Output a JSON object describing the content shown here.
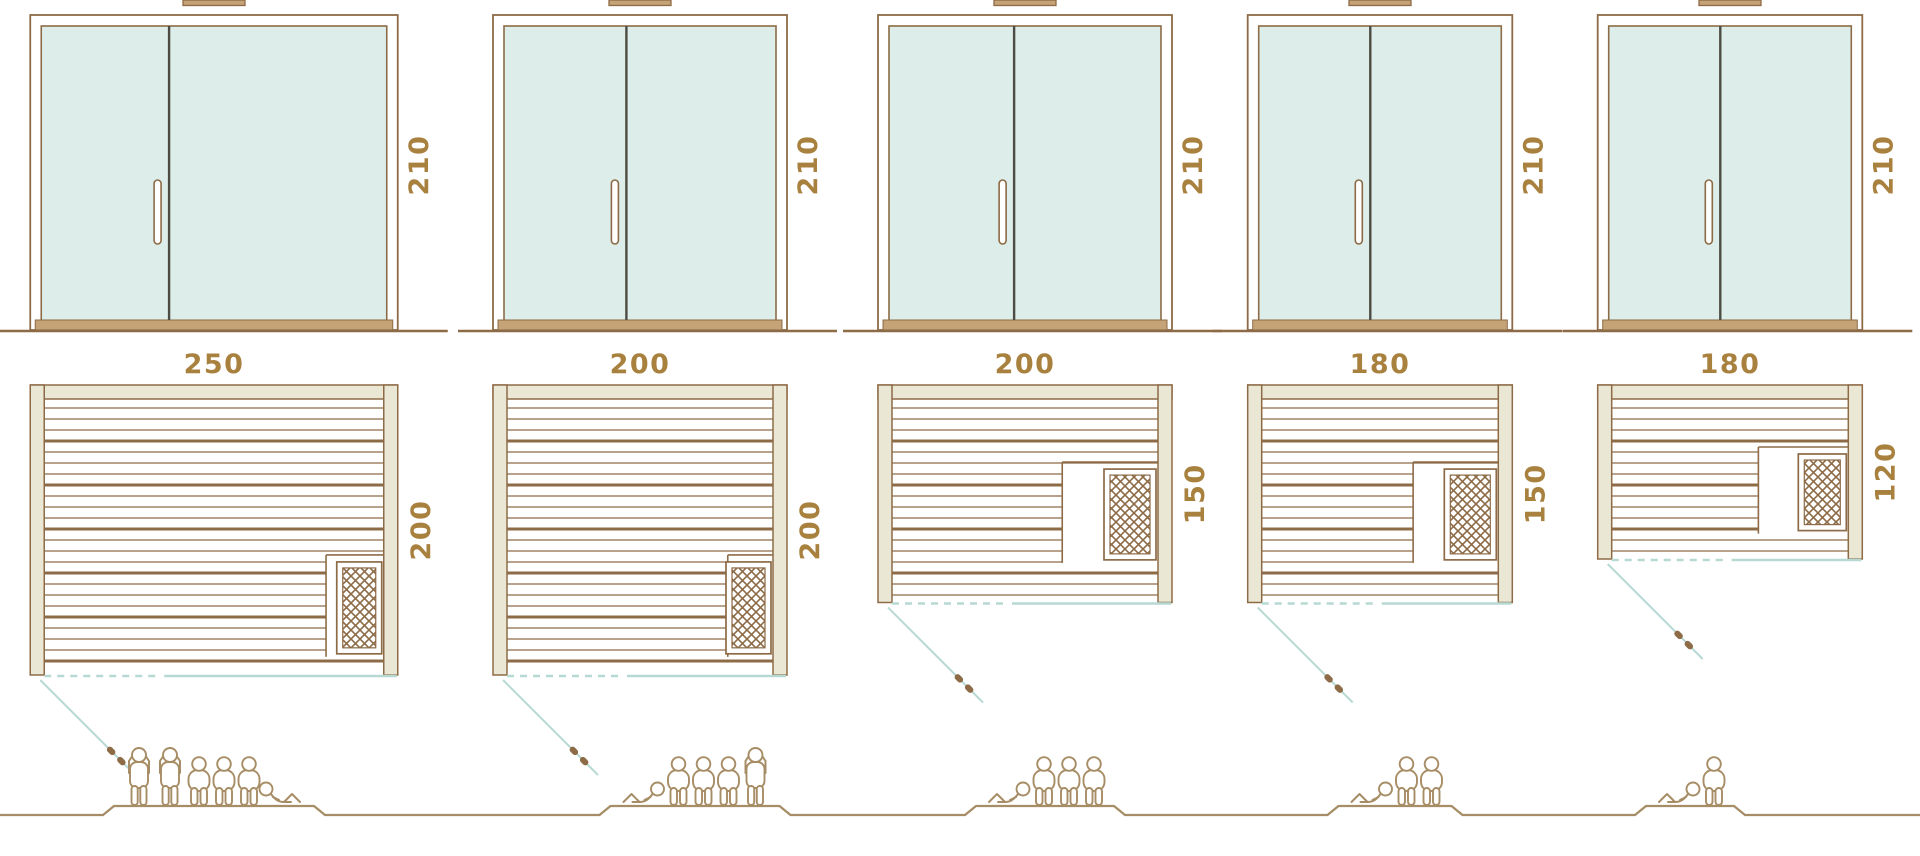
{
  "title": "Sauna size comparison diagram",
  "colors": {
    "line_brown": "#8d6b46",
    "label_gold": "#a9813f",
    "wall_fill": "#eae7d4",
    "glass_fill": "#ddede9",
    "divider_dark": "#4d4c44",
    "swing_teal": "#b7d9d3",
    "people_brown": "#a78d65",
    "threshold_tan": "#c5a377",
    "white": "#ffffff"
  },
  "units": [
    {
      "name": "sauna-250x200",
      "door_height_label": "210",
      "width_label": "250",
      "depth_label": "200",
      "door_height_cm": 210,
      "width_cm": 250,
      "depth_cm": 200,
      "capacity": {
        "standing": 2,
        "seated": 3,
        "lying": 1
      }
    },
    {
      "name": "sauna-200x200",
      "door_height_label": "210",
      "width_label": "200",
      "depth_label": "200",
      "door_height_cm": 210,
      "width_cm": 200,
      "depth_cm": 200,
      "capacity": {
        "standing": 1,
        "seated": 3,
        "lying": 1
      }
    },
    {
      "name": "sauna-200x150",
      "door_height_label": "210",
      "width_label": "200",
      "depth_label": "150",
      "door_height_cm": 210,
      "width_cm": 200,
      "depth_cm": 150,
      "capacity": {
        "standing": 0,
        "seated": 3,
        "lying": 1
      }
    },
    {
      "name": "sauna-180x150",
      "door_height_label": "210",
      "width_label": "180",
      "depth_label": "150",
      "door_height_cm": 210,
      "width_cm": 180,
      "depth_cm": 150,
      "capacity": {
        "standing": 0,
        "seated": 2,
        "lying": 1
      }
    },
    {
      "name": "sauna-180x120",
      "door_height_label": "210",
      "width_label": "180",
      "depth_label": "120",
      "door_height_cm": 210,
      "width_cm": 180,
      "depth_cm": 120,
      "capacity": {
        "standing": 0,
        "seated": 1,
        "lying": 1
      }
    }
  ]
}
